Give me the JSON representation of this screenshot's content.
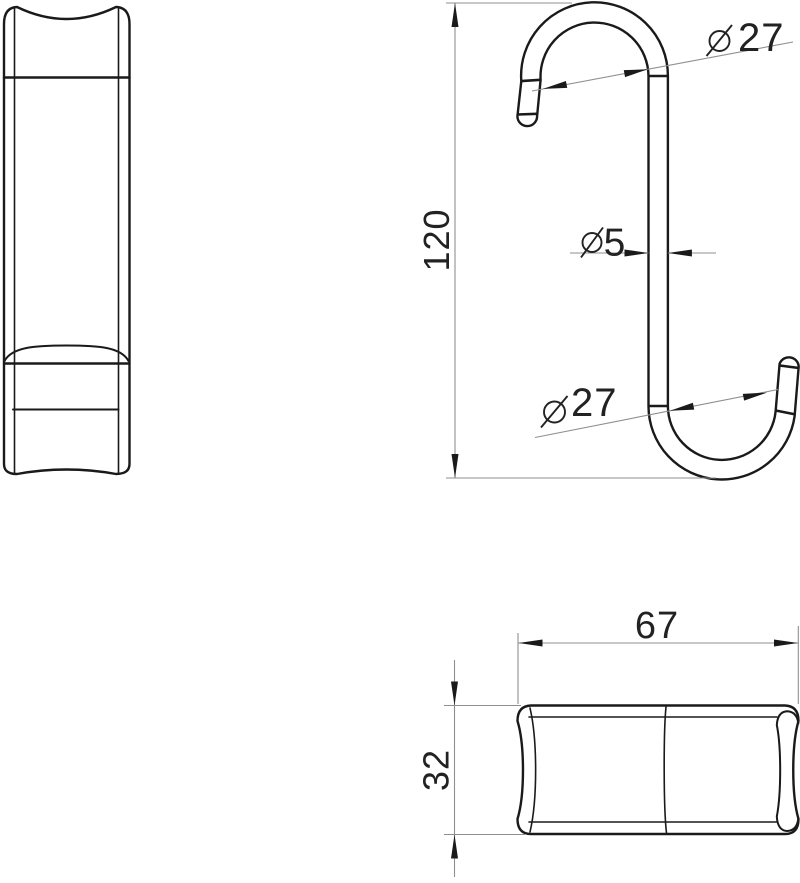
{
  "drawing": {
    "title": "S-hook technical drawing, three orthographic views",
    "colors": {
      "background": "#ffffff",
      "object_line": "#1a1a1a",
      "dimension_line": "#8f8f8f",
      "text": "#222222"
    },
    "views": {
      "front": {
        "name": "front-view"
      },
      "side": {
        "name": "side-view"
      },
      "top": {
        "name": "top-view"
      }
    },
    "dimensions": {
      "height": {
        "value": "120"
      },
      "wire_diameter": {
        "symbol": "diameter",
        "value": "5"
      },
      "top_hook_diameter": {
        "symbol": "diameter",
        "value": "27"
      },
      "bottom_hook_diameter": {
        "symbol": "diameter",
        "value": "27"
      },
      "overall_width": {
        "value": "67"
      },
      "overall_depth": {
        "value": "32"
      }
    }
  }
}
